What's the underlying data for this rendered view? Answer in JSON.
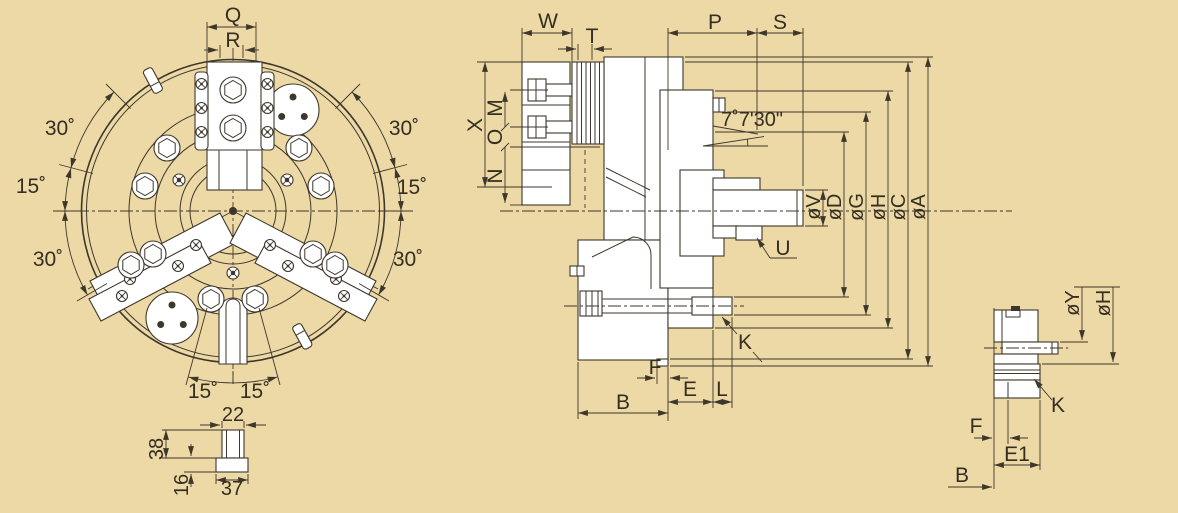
{
  "drawing": {
    "subject": "3-jaw power chuck technical drawing: front view, cross-section view and mounting detail view"
  },
  "colors": {
    "background": "#edd9a6",
    "line": "#3d372c",
    "text": "#352e22",
    "fill": "#ffffff"
  },
  "front_view": {
    "q": "Q",
    "r": "R",
    "angle_upper_left": "30˚",
    "angle_mid_left": "15˚",
    "angle_lower_left": "30˚",
    "angle_upper_right": "30˚",
    "angle_mid_right": "15˚",
    "angle_lower_right": "30˚",
    "angle_bottom_left": "15˚",
    "angle_bottom_right": "15˚",
    "tnut": {
      "width_top": "22",
      "height_upper": "38",
      "height_lower": "16",
      "width_bottom": "37"
    }
  },
  "section_view": {
    "w": "W",
    "t": "T",
    "p": "P",
    "s": "S",
    "x": "X",
    "m": "M",
    "o": "O",
    "n": "N",
    "taper_angle": "7˚7'30\"",
    "dia_v": "øV",
    "dia_d": "øD",
    "dia_g": "øG",
    "dia_h": "øH",
    "dia_c": "øC",
    "dia_a": "øA",
    "u": "U",
    "k": "K",
    "f": "F",
    "e": "E",
    "l": "L",
    "b": "B"
  },
  "detail_view": {
    "dia_y": "øY",
    "dia_h": "øH",
    "k": "K",
    "f": "F",
    "e1": "E1",
    "b": "B"
  }
}
